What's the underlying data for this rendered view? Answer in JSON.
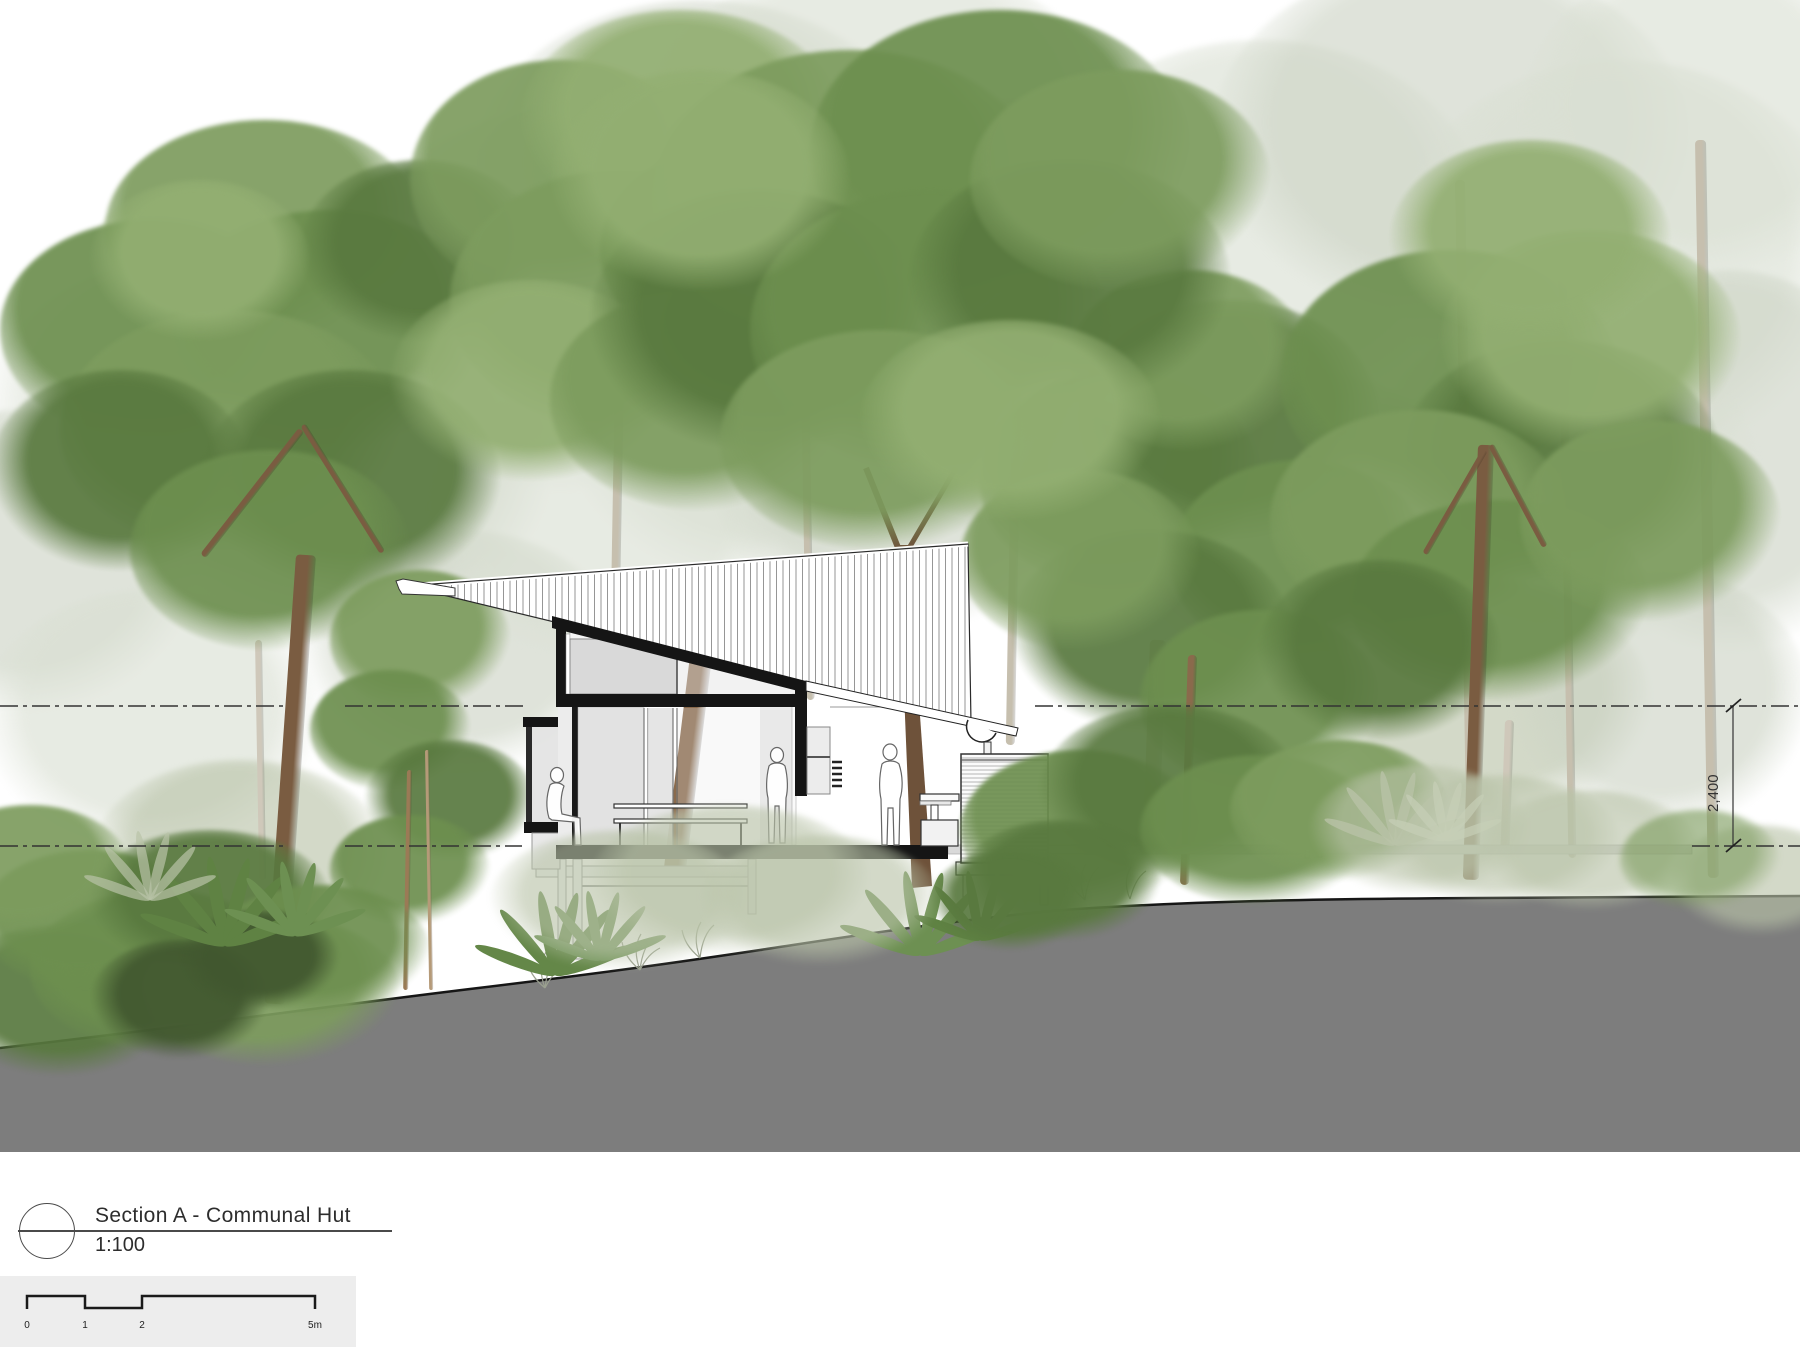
{
  "drawing": {
    "title": "Section A - Communal Hut",
    "scale_label": "1:100",
    "dimension_label": "2,400",
    "scale_bar": {
      "labels": [
        "0",
        "1",
        "2",
        "5m"
      ]
    }
  },
  "palette": {
    "ink": "#1c1c1c",
    "ground": "#7d7d7d",
    "glass": "#e2e2e2",
    "panel": "#d9d9d9",
    "band": "#d9d9d9",
    "titlebg": "#ededed",
    "green1": "#6d8f4f",
    "green2": "#7d9c5e",
    "green3": "#59793f",
    "green4": "#93af72",
    "paleleaf1": "#ccd3c4",
    "paleleaf2": "#d9dfd2",
    "paleleaf3": "#b9c3a8",
    "darkleaf": "#41572f",
    "trunk": "#8a6a4c",
    "trunkdark": "#6e523a",
    "trunkpale": "#c6bfae"
  }
}
